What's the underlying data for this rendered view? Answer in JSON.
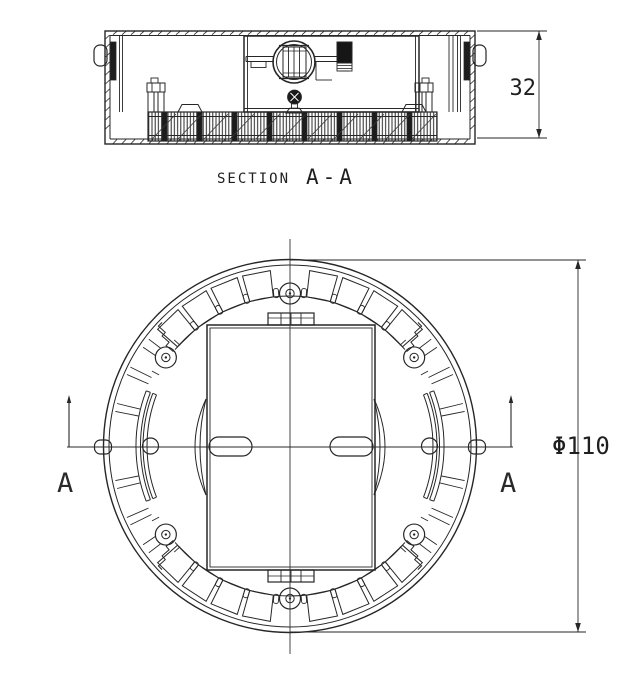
{
  "drawing": {
    "background": "#ffffff",
    "line_color": "#262626"
  },
  "section_view": {
    "label_prefix": "SECTION",
    "label_ref": "A-A",
    "height_dim": "32"
  },
  "plan_view": {
    "diameter_dim": "Φ110",
    "cut_marker_left": "A",
    "cut_marker_right": "A"
  }
}
